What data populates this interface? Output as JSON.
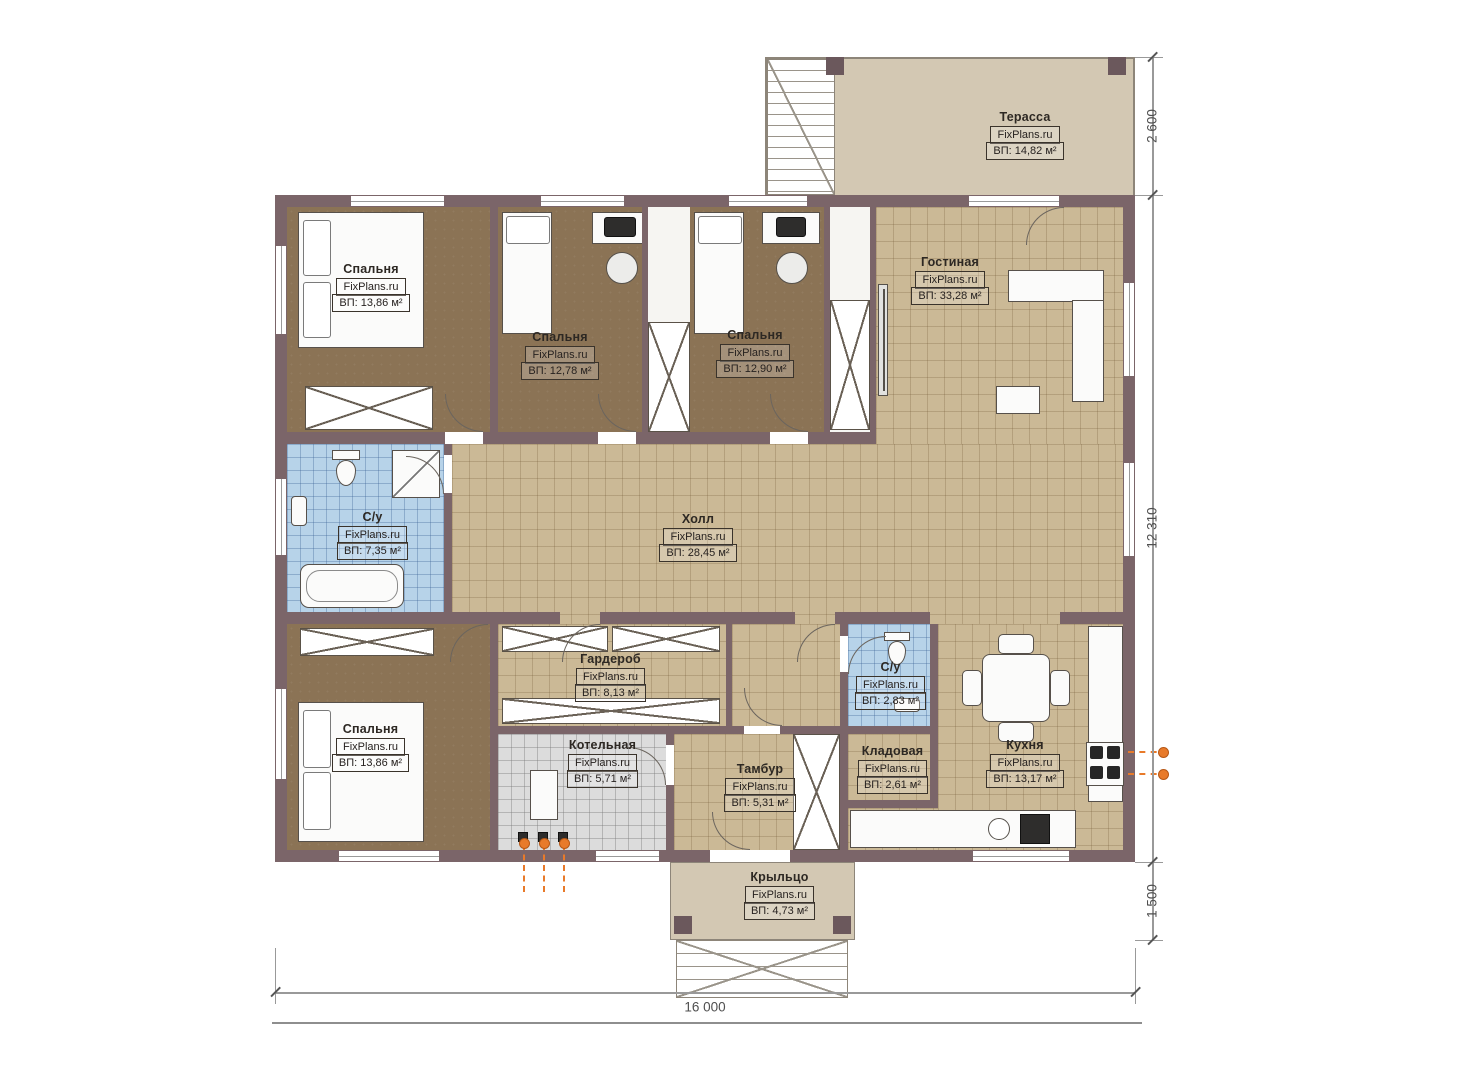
{
  "watermark": "FixPlans.ru",
  "rooms": [
    {
      "name": "Спальня",
      "area": "ВП: 13,86 м²"
    },
    {
      "name": "Спальня",
      "area": "ВП: 12,78 м²"
    },
    {
      "name": "Спальня",
      "area": "ВП: 12,90 м²"
    },
    {
      "name": "Гостиная",
      "area": "ВП: 33,28 м²"
    },
    {
      "name": "Терасса",
      "area": "ВП: 14,82 м²"
    },
    {
      "name": "Холл",
      "area": "ВП: 28,45 м²"
    },
    {
      "name": "С/у",
      "area": "ВП: 7,35 м²"
    },
    {
      "name": "Спальня",
      "area": "ВП: 13,86 м²"
    },
    {
      "name": "Гардероб",
      "area": "ВП: 8,13 м²"
    },
    {
      "name": "Котельная",
      "area": "ВП: 5,71 м²"
    },
    {
      "name": "Тамбур",
      "area": "ВП: 5,31 м²"
    },
    {
      "name": "Кладовая",
      "area": "ВП: 2,61 м²"
    },
    {
      "name": "С/у",
      "area": "ВП: 2,83 м²"
    },
    {
      "name": "Кухня",
      "area": "ВП: 13,17 м²"
    },
    {
      "name": "Крыльцо",
      "area": "ВП: 4,73 м²"
    }
  ],
  "dimensions": {
    "terrace_depth": "2 600",
    "house_depth": "12 310",
    "porch_depth": "1 500",
    "house_width": "16 000"
  },
  "colors": {
    "wall": "#7b6569",
    "floor_wood": "#8b7355",
    "tile_tan": "#cbb996",
    "tile_blue": "#b7d3e9",
    "tile_gray": "#dcdcdc",
    "terrace": "#d3c8b3",
    "utility_accent": "#e87a2a"
  }
}
